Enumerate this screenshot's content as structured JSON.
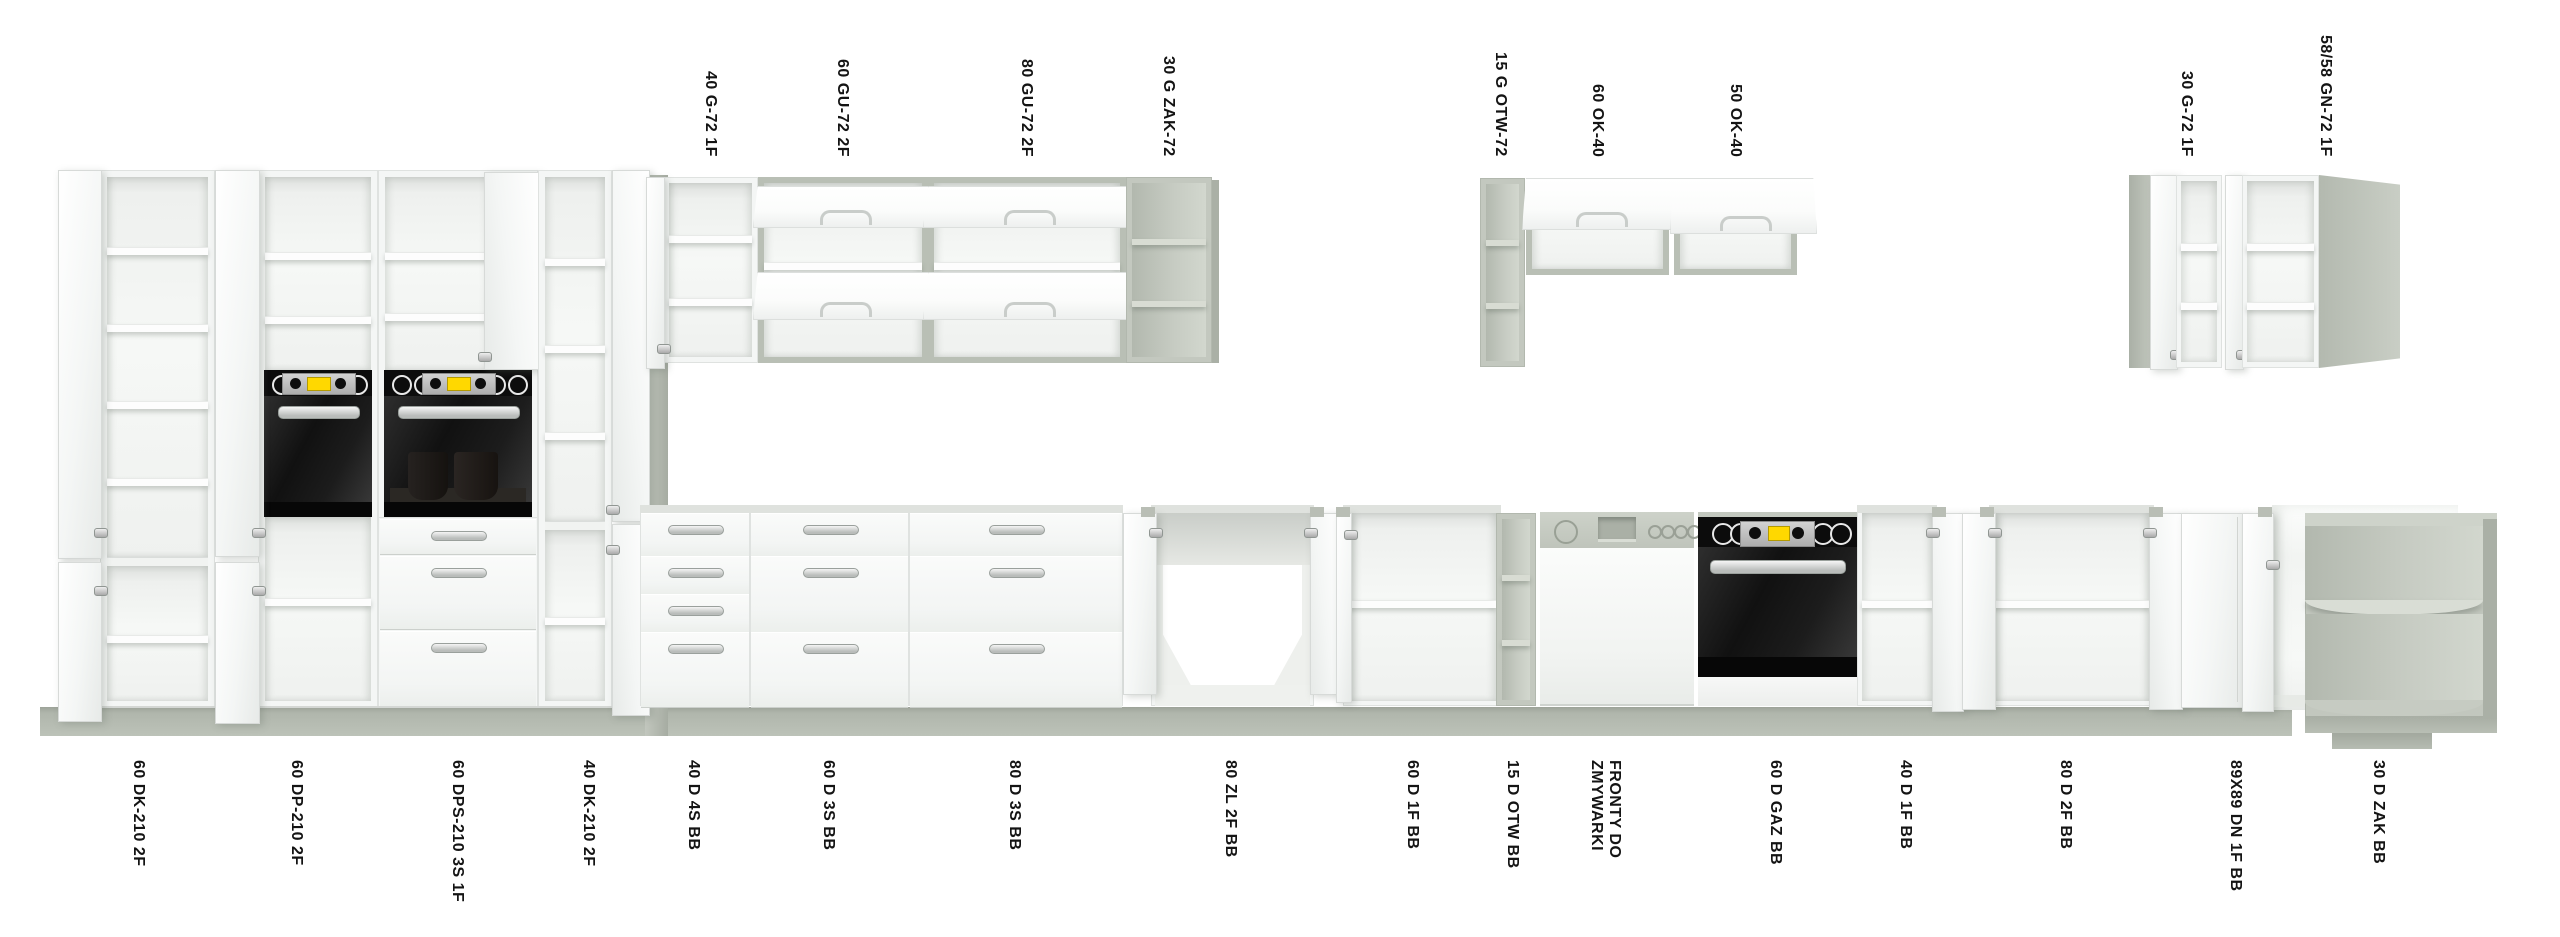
{
  "canvas": {
    "w": 2560,
    "h": 937,
    "bg": "#ffffff"
  },
  "colors": {
    "floor": "#aeb4aa",
    "wall_strip": "#b2b8ae",
    "carcass_white": "#f4f6f5",
    "gray_frame": "#c3c8bf",
    "oven_black": "#0c0c0c",
    "display_yellow": "#ffd800",
    "handle_silver": "#b9bcba",
    "label_text": "#141414"
  },
  "labels": {
    "top_baseline_y": 157,
    "bottom_top_y": 760,
    "top": [
      {
        "text": "40 G-72 1F",
        "x": 710
      },
      {
        "text": "60 GU-72 2F",
        "x": 842
      },
      {
        "text": "80 GU-72 2F",
        "x": 1026
      },
      {
        "text": "30 G ZAK-72",
        "x": 1168
      },
      {
        "text": "15 G OTW-72",
        "x": 1500
      },
      {
        "text": "60 OK-40",
        "x": 1597
      },
      {
        "text": "50 OK-40",
        "x": 1735
      },
      {
        "text": "30 G-72 1F",
        "x": 2186
      },
      {
        "text": "58/58 GN-72 1F",
        "x": 2325
      }
    ],
    "bottom": [
      {
        "text": "60 DK-210 2F",
        "x": 138
      },
      {
        "text": "60 DP-210 2F",
        "x": 296
      },
      {
        "text": "60 DPS-210 3S 1F",
        "x": 457
      },
      {
        "text": "40 DK-210 2F",
        "x": 588
      },
      {
        "text": "40 D 4S BB",
        "x": 693
      },
      {
        "text": "60 D 3S BB",
        "x": 828
      },
      {
        "text": "80 D 3S BB",
        "x": 1014
      },
      {
        "text": "80 ZL 2F BB",
        "x": 1230
      },
      {
        "text": "60 D 1F BB",
        "x": 1412
      },
      {
        "text": "15 D OTW BB",
        "x": 1512
      },
      {
        "text": "FRONTY DO\nZMYWARKI",
        "x": 1605
      },
      {
        "text": "60 D GAZ BB",
        "x": 1775
      },
      {
        "text": "40 D 1F BB",
        "x": 1905
      },
      {
        "text": "80 D 2F BB",
        "x": 2065
      },
      {
        "text": "89X89 DN 1F BB",
        "x": 2235
      },
      {
        "text": "30 D ZAK BB",
        "x": 2378
      }
    ]
  },
  "scene": {
    "floor": {
      "x": 40,
      "y": 707,
      "w": 2252,
      "h": 29
    },
    "wall_strip": {
      "x": 645,
      "y": 175,
      "w": 23,
      "h": 561
    },
    "corner_plinth": {
      "x": 2332,
      "y": 733,
      "w": 100,
      "h": 16
    }
  },
  "modules": [
    {
      "code": "60 DK-210 2F",
      "kind": "tall",
      "rect": [
        100,
        170,
        115,
        538
      ],
      "shelves": [
        247,
        324,
        401,
        478
      ],
      "split": 557,
      "lshelves": [
        635
      ],
      "doors": [
        {
          "x": 58,
          "y": 170,
          "w": 42,
          "h": 387,
          "hY": [
            528
          ],
          "side": "l"
        },
        {
          "x": 58,
          "y": 562,
          "w": 42,
          "h": 158,
          "hY": [
            586
          ],
          "side": "l"
        }
      ]
    },
    {
      "code": "60 DP-210 2F",
      "kind": "tall",
      "rect": [
        258,
        170,
        120,
        538
      ],
      "shelves": [
        252,
        316
      ],
      "oven": {
        "y": 370
      },
      "lshelves": [
        598
      ],
      "doors": [
        {
          "x": 215,
          "y": 170,
          "w": 43,
          "h": 385,
          "hY": [
            528
          ],
          "side": "l"
        },
        {
          "x": 215,
          "y": 562,
          "w": 43,
          "h": 160,
          "hY": [
            586
          ],
          "side": "l"
        }
      ]
    },
    {
      "code": "60 DPS-210 3S 1F",
      "kind": "tall",
      "rect": [
        378,
        170,
        160,
        538
      ],
      "shelves": [
        252,
        313
      ],
      "oven": {
        "y": 370,
        "cups": true
      },
      "drawers": [
        [
          519,
          34
        ],
        [
          556,
          72
        ],
        [
          631,
          74
        ]
      ],
      "doors": [
        {
          "x": 484,
          "y": 172,
          "w": 54,
          "h": 196,
          "hY": [
            352
          ],
          "side": "r"
        }
      ]
    },
    {
      "code": "40 DK-210 2F",
      "kind": "tall",
      "rect": [
        538,
        170,
        74,
        538
      ],
      "shelves": [
        258,
        345,
        432
      ],
      "split": 521,
      "lshelves": [
        617
      ],
      "doors": [
        {
          "x": 612,
          "y": 170,
          "w": 36,
          "h": 350,
          "hY": [
            505
          ],
          "side": "r"
        },
        {
          "x": 612,
          "y": 524,
          "w": 36,
          "h": 190,
          "hY": [
            545
          ],
          "side": "r"
        }
      ]
    },
    {
      "code": "40 G-72 1F",
      "kind": "wall1f",
      "rect": [
        663,
        177,
        95,
        186
      ],
      "shelves": [
        235,
        298
      ],
      "door": {
        "x": 646,
        "y": 177,
        "w": 17,
        "h": 190,
        "hY": [
          344
        ],
        "side": "l"
      }
    },
    {
      "code": "60 GU-72 2F",
      "kind": "wallgu",
      "rect": [
        758,
        177,
        170,
        186
      ],
      "midshelf": 262,
      "slabs": [
        {
          "y": 186,
          "h": 40
        },
        {
          "y": 272,
          "h": 46
        }
      ]
    },
    {
      "code": "80 GU-72 2F",
      "kind": "wallgu",
      "rect": [
        928,
        177,
        198,
        186
      ],
      "midshelf": 262,
      "slabs": [
        {
          "y": 186,
          "h": 40
        },
        {
          "y": 272,
          "h": 46
        }
      ]
    },
    {
      "code": "30 G ZAK-72",
      "kind": "grayopen",
      "rect": [
        1126,
        177,
        86,
        186
      ],
      "shelves": [
        239,
        301
      ],
      "sideR": 7
    },
    {
      "code": "15 G OTW-72",
      "kind": "grayopen",
      "rect": [
        1480,
        178,
        45,
        189
      ],
      "shelves": [
        240,
        303
      ]
    },
    {
      "code": "60 OK-40",
      "kind": "wallok",
      "rect": [
        1526,
        178,
        143,
        97
      ],
      "slab": {
        "x": 1522,
        "y": 178,
        "w": 154,
        "h": 50
      }
    },
    {
      "code": "50 OK-40",
      "kind": "wallok",
      "rect": [
        1674,
        178,
        123,
        97
      ],
      "slab": {
        "x": 1670,
        "y": 178,
        "w": 145,
        "h": 54
      }
    },
    {
      "code": "30 G-72 1F",
      "kind": "wall30c",
      "grayside": [
        2129,
        175,
        21,
        193
      ],
      "doorface": [
        2150,
        175,
        26,
        193
      ],
      "rect": [
        2176,
        175,
        46,
        193
      ],
      "shelves": [
        243,
        302
      ]
    },
    {
      "code": "58/58 GN-72 1F",
      "kind": "wallgn",
      "door": {
        "x": 2225,
        "y": 175,
        "w": 17,
        "h": 193,
        "hY": [
          350
        ],
        "side": "l"
      },
      "rect": [
        2242,
        175,
        77,
        193
      ],
      "shelves": [
        243,
        302
      ],
      "graypanel": [
        2319,
        175,
        81,
        193
      ]
    },
    {
      "code": "40 D 4S BB",
      "kind": "drawers",
      "rect": [
        640,
        505,
        110,
        201
      ],
      "rows": [
        [
          513,
          42
        ],
        [
          556,
          37
        ],
        [
          594,
          37
        ],
        [
          632,
          74
        ]
      ]
    },
    {
      "code": "60 D 3S BB",
      "kind": "drawers",
      "rect": [
        750,
        505,
        159,
        201
      ],
      "rows": [
        [
          513,
          42
        ],
        [
          556,
          75
        ],
        [
          632,
          74
        ]
      ]
    },
    {
      "code": "80 D 3S BB",
      "kind": "drawers",
      "rect": [
        909,
        505,
        214,
        201
      ],
      "rows": [
        [
          513,
          42
        ],
        [
          556,
          75
        ],
        [
          632,
          74
        ]
      ]
    },
    {
      "code": "80 ZL 2F BB",
      "kind": "sink",
      "rect": [
        1155,
        513,
        155,
        193
      ],
      "doors": [
        {
          "x": 1123,
          "y": 513,
          "w": 32,
          "h": 180,
          "hY": [
            528
          ],
          "side": "l",
          "cap": true
        },
        {
          "x": 1310,
          "y": 513,
          "w": 28,
          "h": 180,
          "hY": [
            528
          ],
          "side": "r",
          "cap": true
        }
      ]
    },
    {
      "code": "60 D 1F BB",
      "kind": "baseopen",
      "rect": [
        1348,
        513,
        148,
        193
      ],
      "shelf": 600,
      "doors": [
        {
          "x": 1336,
          "y": 513,
          "w": 14,
          "h": 188,
          "hY": [
            530
          ],
          "side": "l",
          "cap": true
        }
      ]
    },
    {
      "code": "15 D OTW BB",
      "kind": "grayopen",
      "rect": [
        1496,
        513,
        40,
        193
      ],
      "shelves": [
        575,
        640
      ]
    },
    {
      "code": "FRONTY DO ZMYWARKI",
      "kind": "dw",
      "rect": [
        1540,
        512,
        154,
        194
      ]
    },
    {
      "code": "60 D GAZ BB",
      "kind": "baseoven",
      "rect": [
        1698,
        512,
        160,
        194
      ]
    },
    {
      "code": "40 D 1F BB",
      "kind": "baseopen",
      "rect": [
        1862,
        513,
        70,
        193
      ],
      "shelf": 600,
      "doors": [
        {
          "x": 1932,
          "y": 513,
          "w": 30,
          "h": 197,
          "hY": [
            528
          ],
          "side": "r",
          "cap": true
        }
      ]
    },
    {
      "code": "80 D 2F BB",
      "kind": "baseopen",
      "rect": [
        1994,
        513,
        155,
        193
      ],
      "shelf": 600,
      "doors": [
        {
          "x": 1962,
          "y": 513,
          "w": 32,
          "h": 195,
          "hY": [
            528
          ],
          "side": "l",
          "cap": true
        },
        {
          "x": 2149,
          "y": 513,
          "w": 32,
          "h": 195,
          "hY": [
            528
          ],
          "side": "r",
          "cap": true
        }
      ]
    },
    {
      "code": "89X89 DN 1F BB",
      "kind": "cornerbase",
      "front": [
        2181,
        513,
        61,
        193
      ],
      "body": [
        2272,
        505,
        186,
        205
      ],
      "doors": [
        {
          "x": 2242,
          "y": 513,
          "w": 30,
          "h": 197,
          "hY": [
            560
          ],
          "side": "l",
          "cap": true
        }
      ]
    },
    {
      "code": "30 D ZAK BB",
      "kind": "cornerzak",
      "rect": [
        2305,
        513,
        192,
        220
      ],
      "shelfY": 600
    }
  ]
}
